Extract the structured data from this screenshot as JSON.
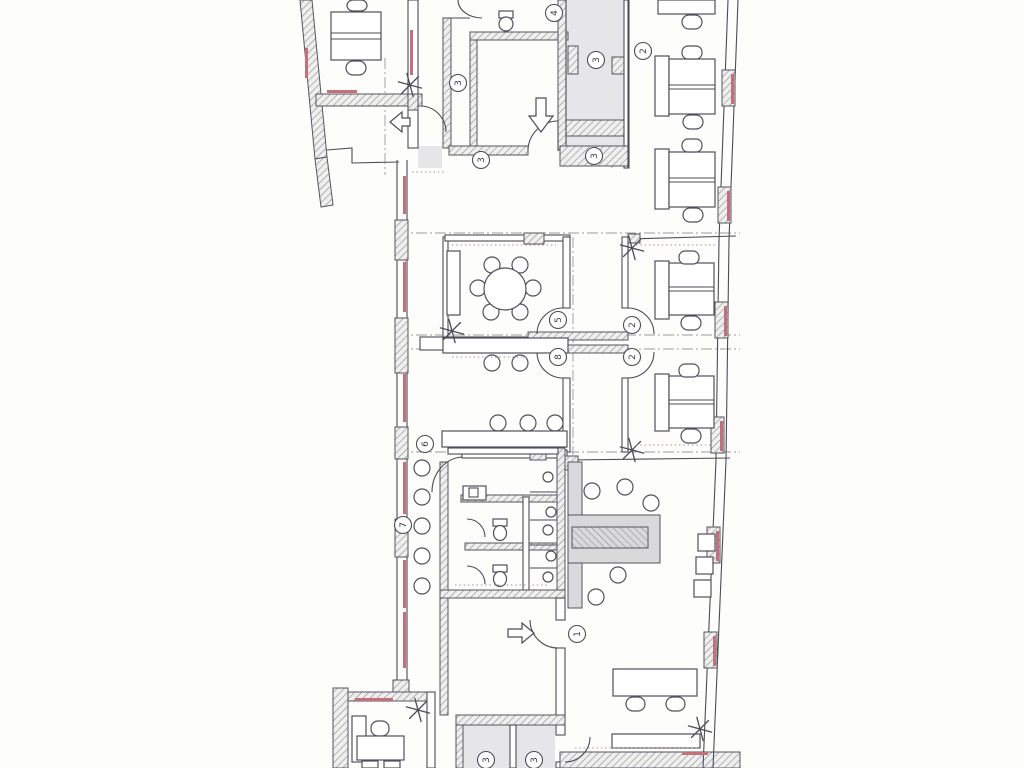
{
  "document": {
    "kind": "scanned office floor plan drawing",
    "visible_text_note": "only circled room/door numbers are legible"
  },
  "colors": {
    "paper": "#fdfdfc",
    "ink": "#4c4c54",
    "wall_hatch": "#8b8b93",
    "corridor_fill": "#e6e6e8",
    "counter_fill": "#d9d9db",
    "window_accent": "#c46f7c",
    "reference_line": "#9a9aa2"
  },
  "icons": {
    "light_fixture": "asterisk-star",
    "entrance_arrow": "outlined-arrow",
    "window_marker": "pink-sill-line"
  },
  "markers": {
    "shaft_duct": "3",
    "south_wall": "3",
    "corridor_upper": "3",
    "corridor_lower": "3",
    "open_office": "2",
    "wc_upper": "4",
    "meeting_room": "5",
    "multi_room": "8",
    "office_one": "2",
    "office_two": "2",
    "hall_door": "6",
    "west_wall": "7",
    "entry_hall": "1",
    "store_left": "3",
    "store_right": "3"
  }
}
